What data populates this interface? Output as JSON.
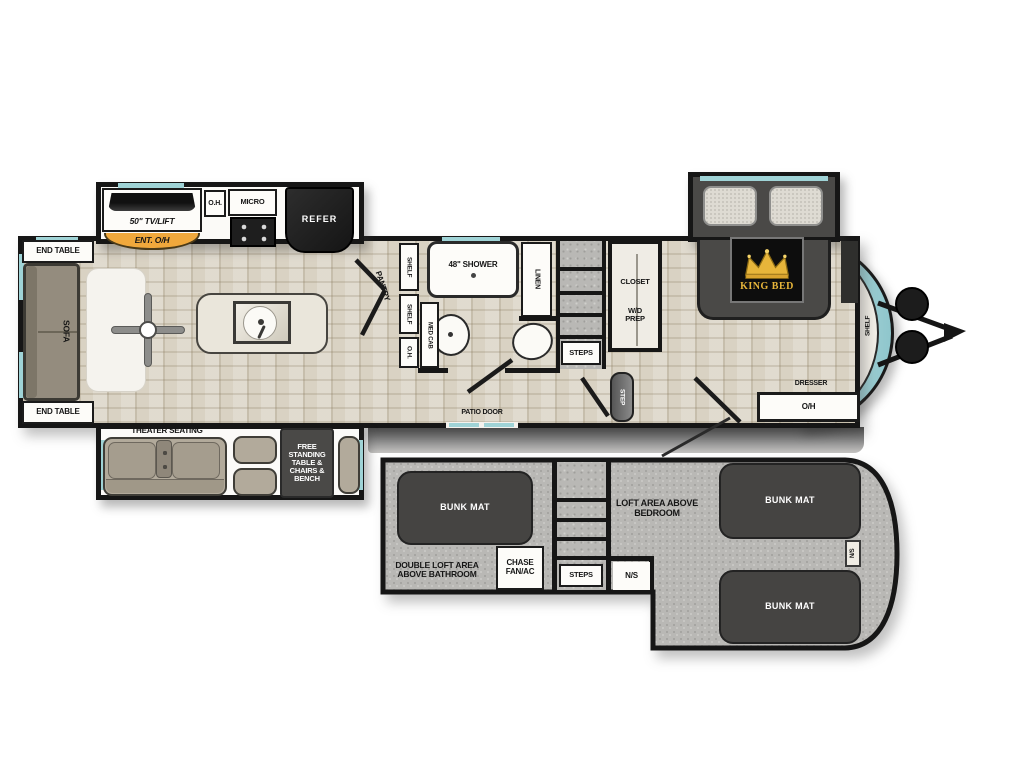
{
  "floorplan": {
    "main": {
      "end_table_top": "END TABLE",
      "sofa": "SOFA",
      "end_table_bottom": "END TABLE",
      "tv_lift": "50\" TV/LIFT",
      "ent_oh": "ENT. O/H",
      "oh_cab": "O.H.",
      "micro": "MICRO",
      "refer": "REFER",
      "theater_seating": "THEATER SEATING",
      "free_standing": "FREE STANDING TABLE & CHAIRS & BENCH",
      "pantry": "PANTRY",
      "shelf_upper": "SHELF",
      "shelf_lower": "SHELF",
      "oh_bath": "O.H.",
      "med_cab": "MED CAB",
      "shower": "48\" SHOWER",
      "linen": "LINEN",
      "steps": "STEPS",
      "closet": "CLOSET",
      "wd_prep": "W/D PREP",
      "step": "STEP",
      "patio_door": "PATIO DOOR",
      "king_bed": "KING BED",
      "dresser": "DRESSER",
      "dresser_oh": "O/H",
      "shelf_front": "SHELF"
    },
    "loft": {
      "bunk_left": "BUNK MAT",
      "double_loft_area": "DOUBLE LOFT AREA ABOVE BATHROOM",
      "chase_fan": "CHASE FAN/AC",
      "steps": "STEPS",
      "ns_door": "N/S",
      "loft_area": "LOFT AREA ABOVE BEDROOM",
      "bunk_upper": "BUNK MAT",
      "bunk_lower": "BUNK MAT",
      "ns_side": "N/S"
    },
    "colors": {
      "teal_accent": "#9fd3d6",
      "orange_accent": "#f0a83c",
      "wall_black": "#161616",
      "floor_beige": "#d9d2c3",
      "loft_gray": "#b9b8b5",
      "dark_furniture": "#454442",
      "crown_gold": "#e7b53a"
    }
  }
}
